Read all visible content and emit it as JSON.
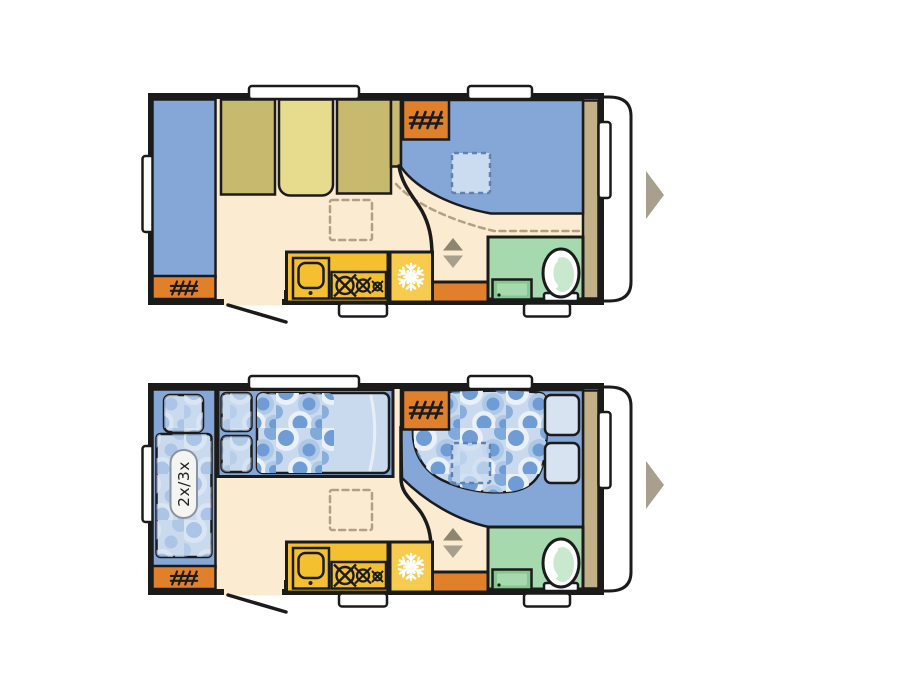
{
  "page_bg": "#ffffff",
  "palette": {
    "page_bg": "#ffffff",
    "wall": "#1b1b1b",
    "floor": "#FAEBD1",
    "floor_light": "#FDF3E0",
    "body_white": "#ffffff",
    "blue": "#84A7D8",
    "blue_light": "#C9DAEE",
    "blue_pale": "#D8E3F2",
    "circle_solid": "#6F9CD4",
    "circle_ring": "#EAF0F8",
    "circle_ring_soft": "#AEC8E8",
    "circle_solid_lt": "#9DBAE2",
    "circle_ring_lt": "#E3EBF6",
    "circle_ring_soft_lt": "#CBD9EE",
    "vent_fill": "#CBDCF0",
    "vent_dash": "#5E81AF",
    "khaki": "#C7BA6E",
    "khaki_light": "#E7DB8D",
    "wardrobe_tan": "#C2B089",
    "orange": "#E0802A",
    "kitchen_yellow": "#F5C02F",
    "fridge_yellow": "#F7CB4E",
    "bath_green": "#A6D9AD",
    "bath_green_dark": "#85C78F",
    "toilet_green": "#C9E9CF",
    "dash_tan": "#B1A084",
    "arrow_up": "#8D8570",
    "arrow_down": "#A89F8C",
    "nav_arrow": "#A89F8E",
    "label_text": "#222222",
    "label_pill_stroke": "#8A94A0",
    "label_pill_fill": "#F4F5F2"
  },
  "icons": {
    "heater": "hatch-grille",
    "fridge": "snowflake",
    "hob": "crossed-burners",
    "nav": "right-triangle-arrow",
    "steps": "up-down-triangles"
  },
  "floorplans": [
    {
      "id": "day-layout"
    },
    {
      "id": "night-layout",
      "bunk_label": "2x/3x"
    }
  ]
}
